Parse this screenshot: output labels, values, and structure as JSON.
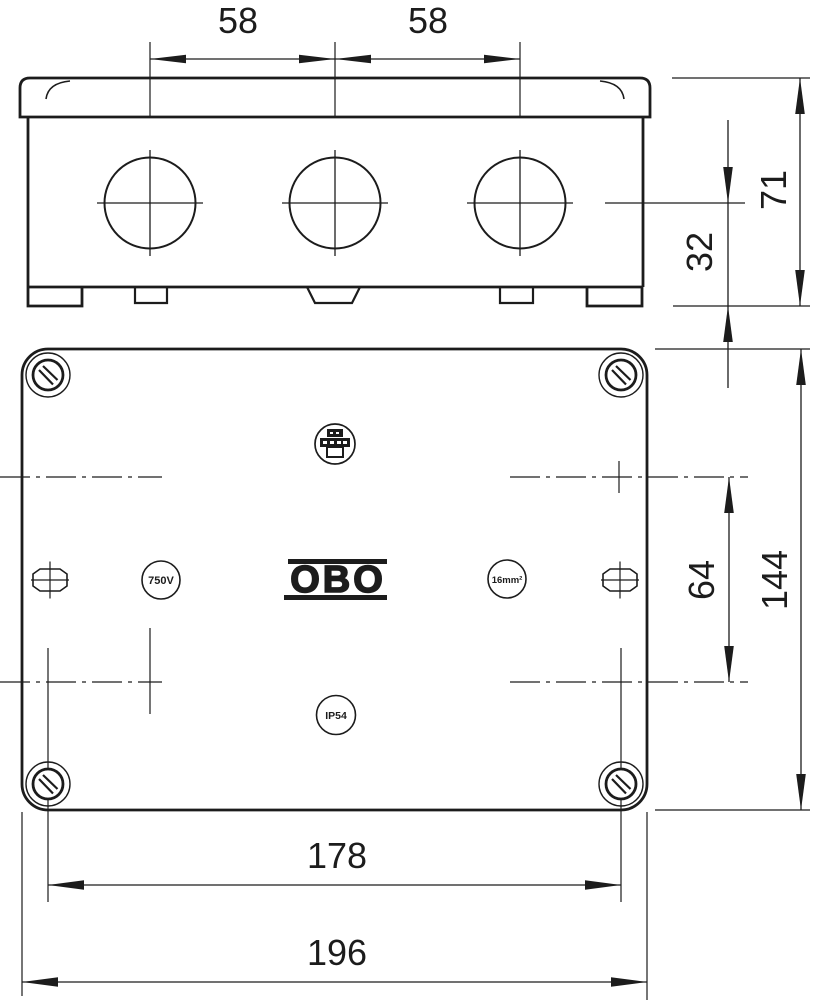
{
  "drawing_title": "junction box dimensional drawing",
  "colors": {
    "background": "#ffffff",
    "line": "#1c1c1c"
  },
  "side_view": {
    "dim_knockout_spacing_left": "58",
    "dim_knockout_spacing_right": "58",
    "dim_total_height": "71",
    "dim_knockout_center_to_base": "32"
  },
  "plan_view": {
    "dim_knockout_row_spacing": "64",
    "dim_body_height": "144",
    "dim_screw_spacing": "178",
    "dim_body_width": "196",
    "logo_text": "OBO",
    "marking_voltage": "750V",
    "marking_cross_section": "16mm²",
    "marking_ip_rating": "IP54"
  }
}
